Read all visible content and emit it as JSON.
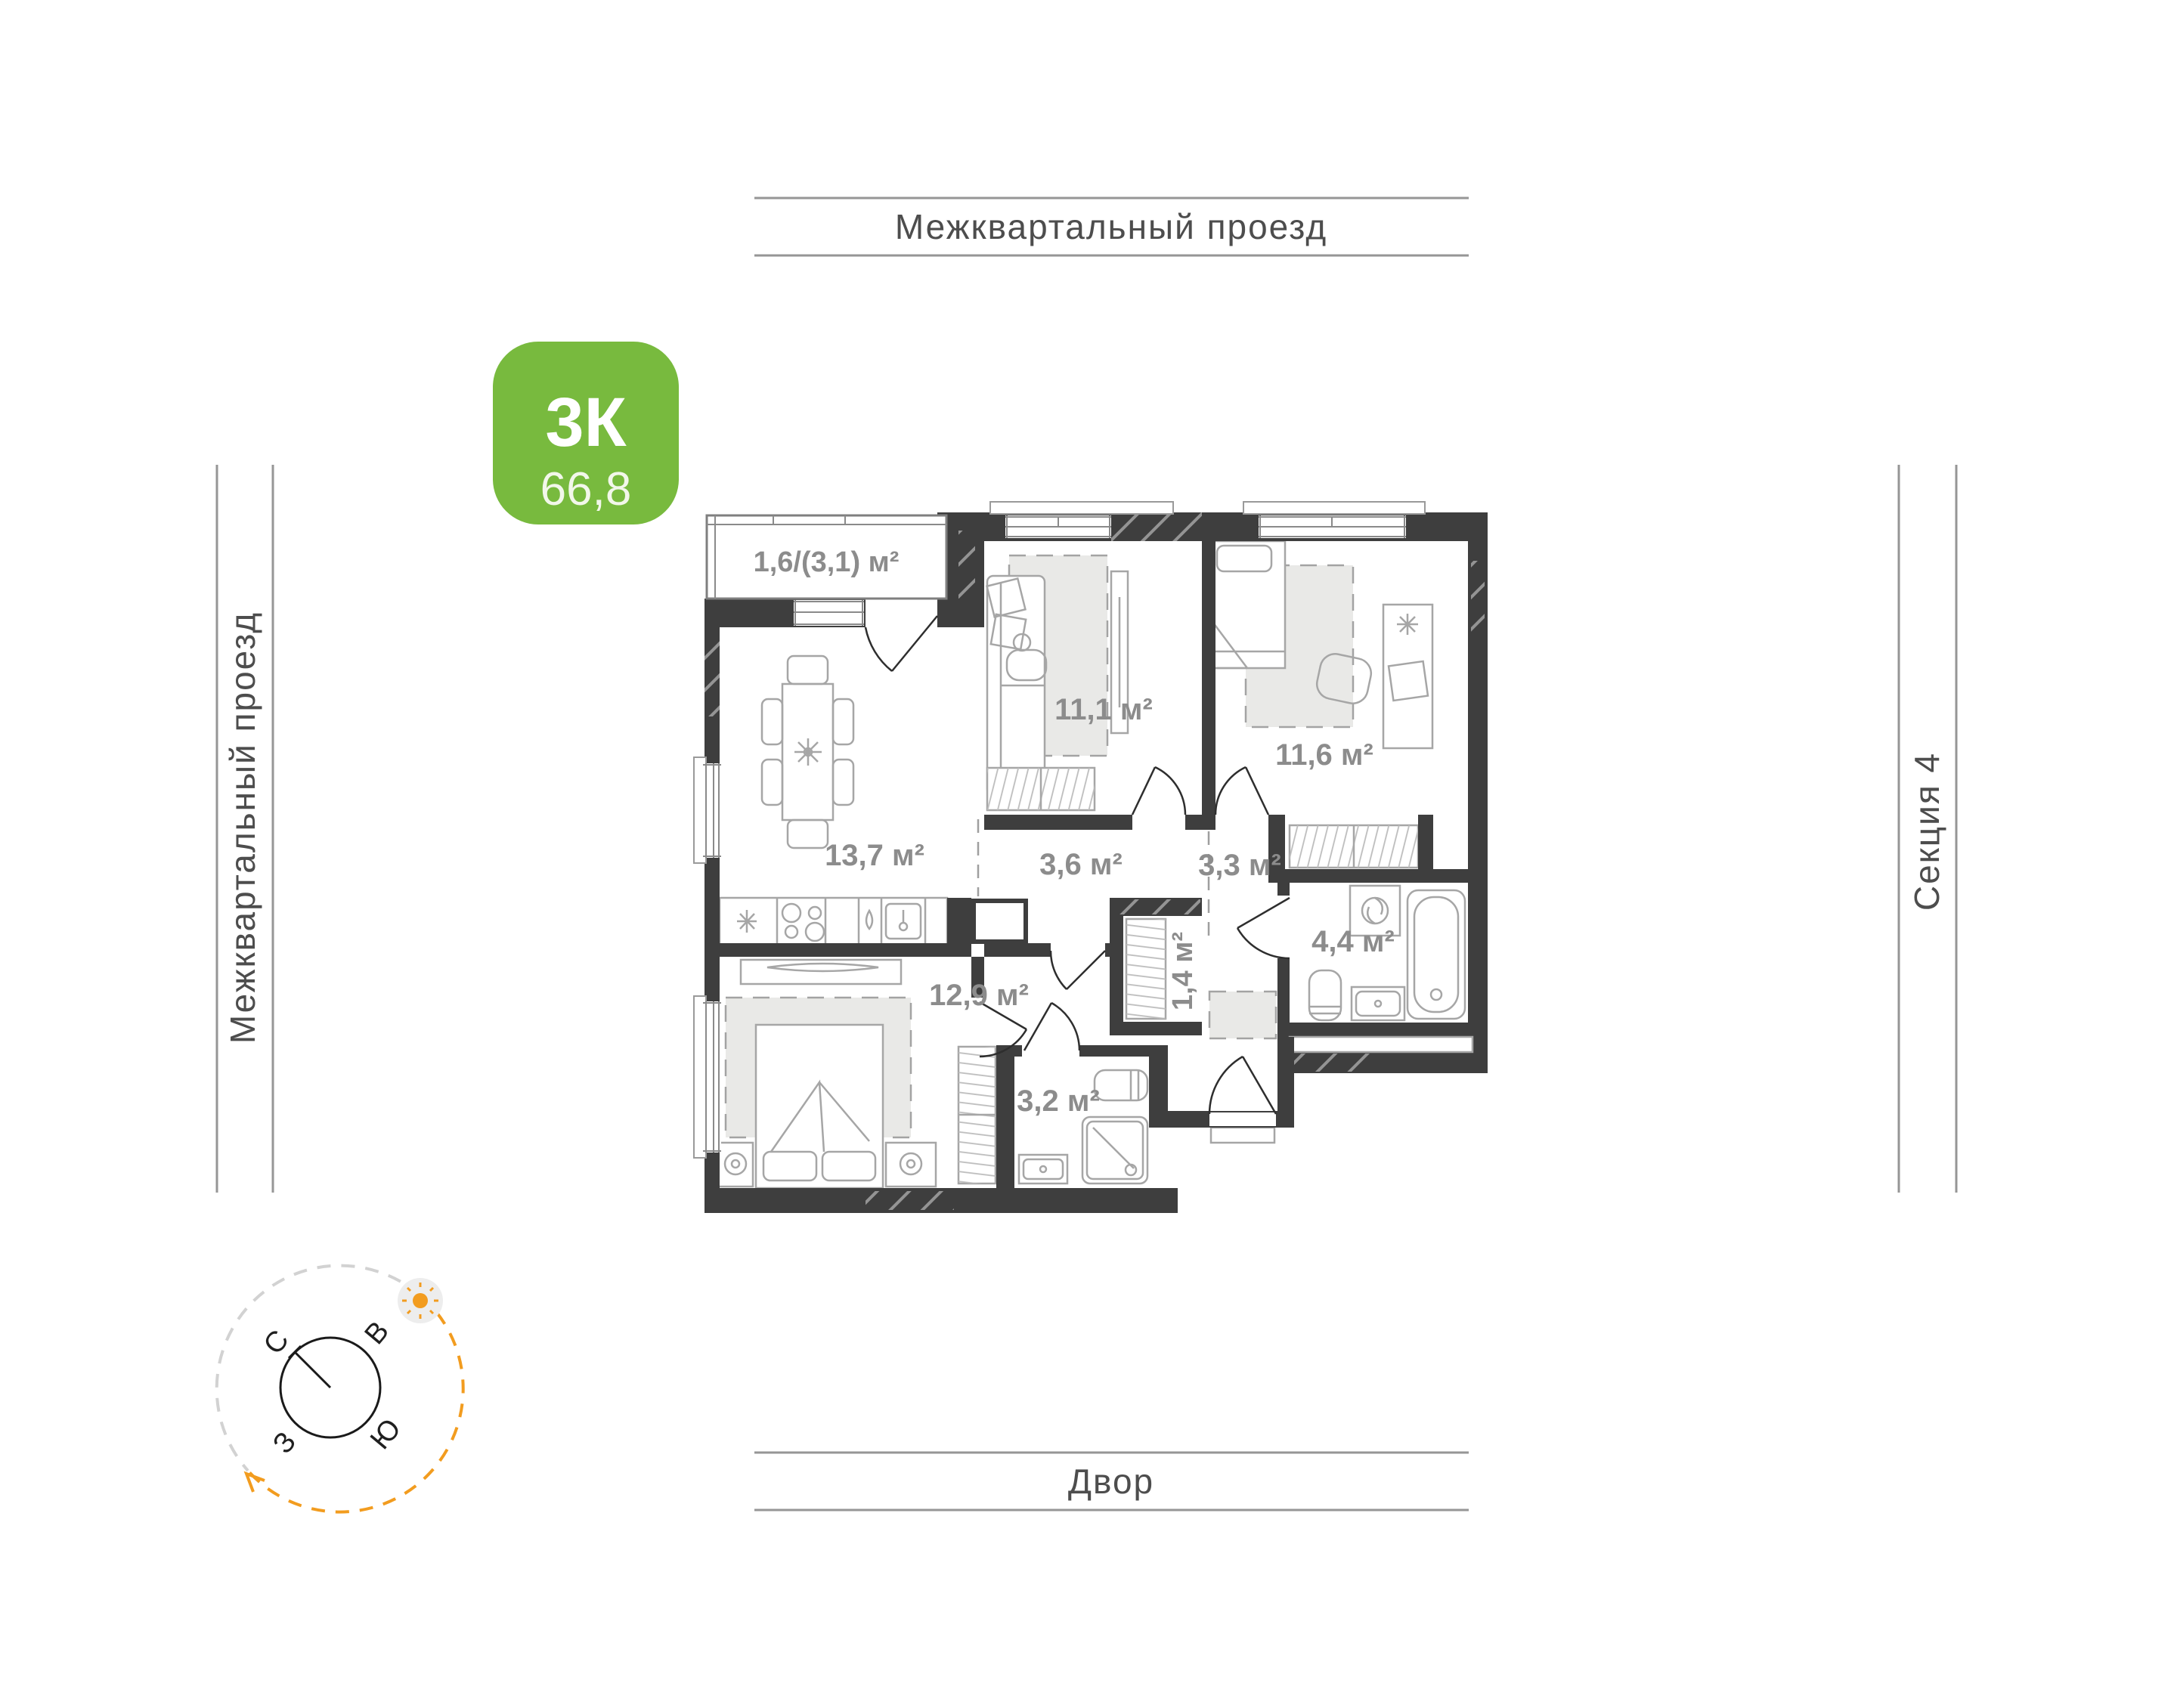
{
  "canvas": {
    "background": "#ffffff"
  },
  "surroundings": {
    "top_label": "Межквартальный проезд",
    "left_label": "Межквартальный проезд",
    "right_label": "Секция 4",
    "bottom_label": "Двор"
  },
  "unit_badge": {
    "rooms_label": "3К",
    "total_area": "66,8",
    "color": "#78ba3e"
  },
  "rooms": {
    "balcony": {
      "area_label": "1,6/(3,1) м²"
    },
    "bedroom1": {
      "area_label": "11,1 м²"
    },
    "bedroom2": {
      "area_label": "11,6 м²"
    },
    "kitchen_living": {
      "area_label": "13,7 м²"
    },
    "corridor": {
      "area_label": "3,6 м²"
    },
    "hall": {
      "area_label": "3,3 м²"
    },
    "bathroom": {
      "area_label": "4,4 м²"
    },
    "closet": {
      "area_label": "1,4 м²"
    },
    "bedroom3": {
      "area_label": "12,9 м²"
    },
    "shower_room": {
      "area_label": "3,2 м²"
    }
  },
  "compass": {
    "north": "С",
    "east": "В",
    "west": "З",
    "south": "Ю"
  },
  "colors": {
    "walls": "#3e3e3e",
    "room_labels": "#8c8c8c",
    "badge_green": "#78ba3e",
    "compass_orange": "#f29c1f"
  }
}
